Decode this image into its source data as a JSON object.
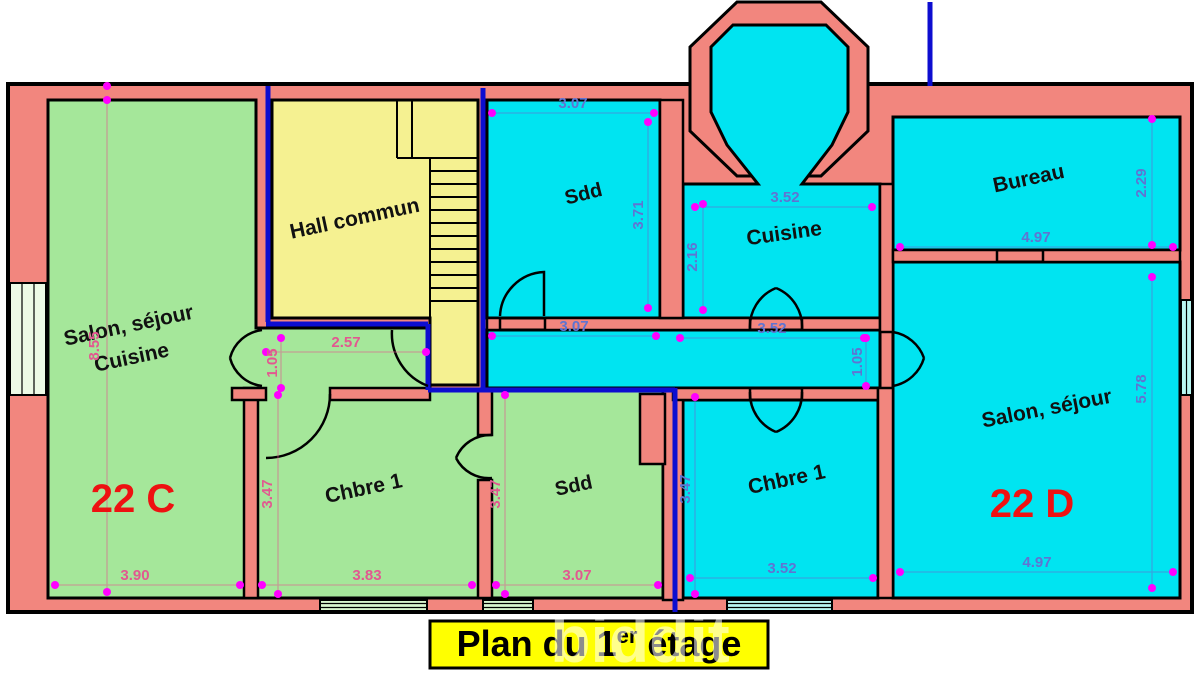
{
  "plan": {
    "title": {
      "prefix": "Plan du 1",
      "sup": "er",
      "suffix": " étage"
    },
    "watermark": "biddit",
    "hall": {
      "label": "Hall commun"
    },
    "apartment_c": {
      "unit": "22 C",
      "salon_line1": "Salon, séjour",
      "salon_line2": "Cuisine",
      "chambre": "Chbre 1",
      "sdd": "Sdd",
      "dims": {
        "salon_height": "8.55",
        "corridor_width": "2.57",
        "corridor_height": "1.05",
        "chambre_height": "3.47",
        "sdd_height": "3.47",
        "salon_width": "3.90",
        "chambre_width": "3.83",
        "sdd_width": "3.07"
      }
    },
    "apartment_d": {
      "unit": "22 D",
      "sdd": "Sdd",
      "cuisine": "Cuisine",
      "bureau": "Bureau",
      "chambre": "Chbre 1",
      "salon": "Salon, séjour",
      "dims": {
        "sdd_width_top": "3.07",
        "sdd_height": "3.71",
        "cuisine_height": "2.16",
        "cuisine_width": "3.52",
        "sdd_width_bottom": "3.07",
        "corridor_width": "3.52",
        "door_height": "1.05",
        "chambre_height": "3.47",
        "chambre_width": "3.52",
        "bureau_width": "4.97",
        "bureau_height": "2.29",
        "salon_height": "5.78",
        "salon_width": "4.97"
      }
    },
    "colors": {
      "wall": "#F2867E",
      "apartment_c_fill": "#A5E79A",
      "apartment_d_fill": "#00E4F1",
      "hall_fill": "#F5F191",
      "boundary_blue": "#0D0DD0",
      "dim_pink": "#E25890",
      "dim_blue": "#5F74D2",
      "unit_red": "#EE1111",
      "title_bg": "#FFFF00",
      "marker_magenta": "#FF00FF"
    }
  }
}
